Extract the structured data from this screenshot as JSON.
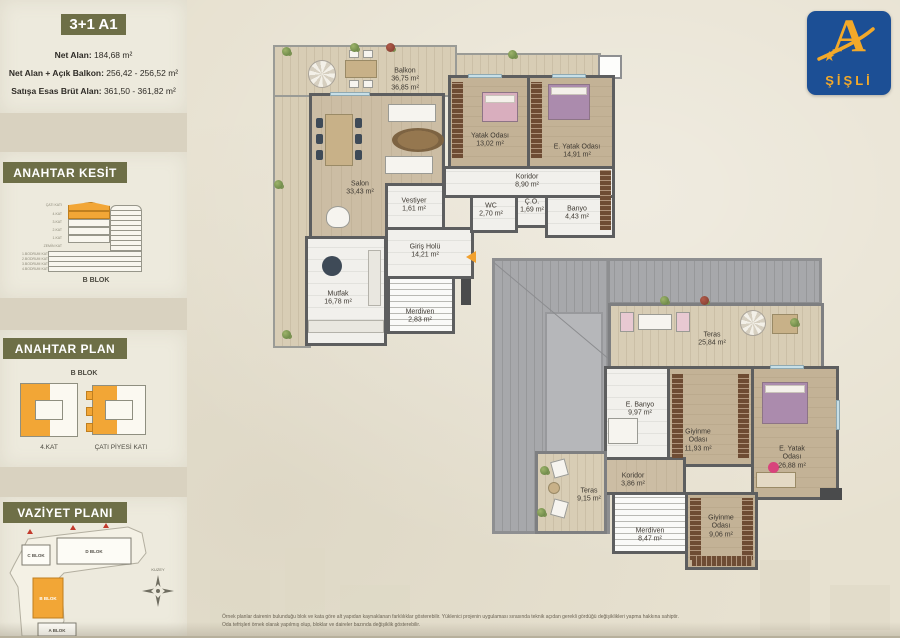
{
  "header": {
    "title": "3+1 A1",
    "specs": [
      {
        "label": "Net Alan: ",
        "value": "184,68 m²"
      },
      {
        "label": "Net Alan + Açık Balkon: ",
        "value": "256,42 - 256,52 m²"
      },
      {
        "label": "Satışa Esas Brüt Alan: ",
        "value": "361,50 - 361,82 m²"
      }
    ]
  },
  "logo": {
    "letter": "A",
    "star": "★",
    "text": "ŞİŞLİ",
    "blue": "#1c4f95",
    "gold": "#f3a929"
  },
  "sections": {
    "kesit": {
      "title": "ANAHTAR KESİT",
      "block_label": "B BLOK",
      "floors": [
        "ÇATI KATI",
        "4.KAT",
        "3.KAT",
        "2.KAT",
        "1.KAT",
        "ZEMİN KAT",
        "1.BODRUM KAT",
        "2.BODRUM KAT",
        "3.BODRUM KAT",
        "4.BODRUM KAT"
      ]
    },
    "plan": {
      "title": "ANAHTAR PLAN",
      "block_label": "B BLOK",
      "left_caption": "4.KAT",
      "right_caption": "ÇATI PİYESİ KATI"
    },
    "vaziyet": {
      "title": "VAZİYET PLANI",
      "blocks": {
        "a": "A BLOK",
        "b": "B BLOK",
        "c": "C BLOK",
        "d": "D BLOK"
      },
      "compass": "KUZEY"
    }
  },
  "floorplans": {
    "upper": {
      "rooms": [
        {
          "name": "Balkon",
          "area": "36,75 m²",
          "area2": "36,85 m²"
        },
        {
          "name": "Salon",
          "area": "33,43 m²"
        },
        {
          "name": "Mutfak",
          "area": "16,78 m²"
        },
        {
          "name": "Vestiyer",
          "area": "1,61 m²"
        },
        {
          "name": "Giriş Holü",
          "area": "14,21 m²"
        },
        {
          "name": "Merdiven",
          "area": "2,83 m²"
        },
        {
          "name": "Yatak Odası",
          "area": "13,02 m²"
        },
        {
          "name": "E. Yatak Odası",
          "area": "14,91 m²"
        },
        {
          "name": "Koridor",
          "area": "8,90 m²"
        },
        {
          "name": "WC",
          "area": "2,70 m²"
        },
        {
          "name": "Ç.O.",
          "area": "1,69 m²"
        },
        {
          "name": "Banyo",
          "area": "4,43 m²"
        }
      ]
    },
    "lower": {
      "rooms": [
        {
          "name": "Teras",
          "area": "25,84 m²"
        },
        {
          "name": "E. Banyo",
          "area": "9,97 m²"
        },
        {
          "name": "Giyinme Odası",
          "area": "11,93 m²"
        },
        {
          "name": "E. Yatak Odası",
          "area": "26,88 m²"
        },
        {
          "name": "Koridor",
          "area": "3,86 m²"
        },
        {
          "name": "Teras",
          "area": "9,15 m²"
        },
        {
          "name": "Merdiven",
          "area": "8,47 m²"
        },
        {
          "name": "Giyinme Odası",
          "area": "9,06 m²"
        }
      ]
    }
  },
  "footnote": {
    "line1": "Örnek planlar dairenin bulunduğu blok ve kata göre alt yapıdan kaynaklanan farklılıklar gösterebilir. Yüklenici projenin uygulaması sırasında teknik açıdan gerekli gördüğü değişiklikleri yapma hakkına sahiptir.",
    "line2": "Oda tefrişleri örnek olarak yapılmış olup, bloklar ve daireler bazında değişiklik gösterebilir."
  }
}
